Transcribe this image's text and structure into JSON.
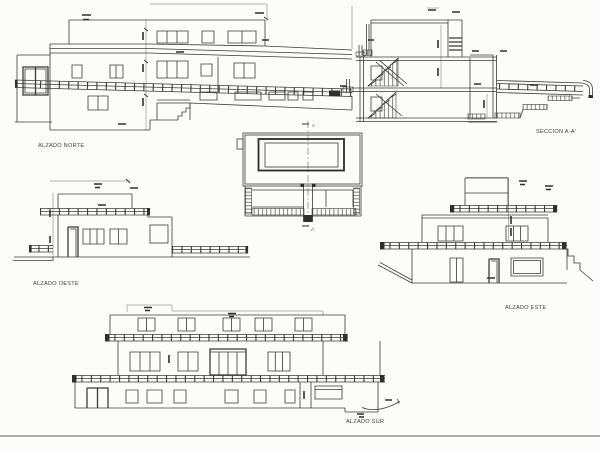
{
  "colors": {
    "paper": "#fcfcfa",
    "ink": "#3a3a3a"
  },
  "labels": {
    "alzado_norte": "ALZADO NORTE",
    "seccion_aa": "SECCION A-A'",
    "alzado_oeste": "ALZADO OESTE",
    "alzado_este": "ALZADO ESTE",
    "alzado_sur": "ALZADO SUR"
  },
  "plan": {
    "section_mark_top": "A",
    "section_mark_bottom": "A'"
  }
}
